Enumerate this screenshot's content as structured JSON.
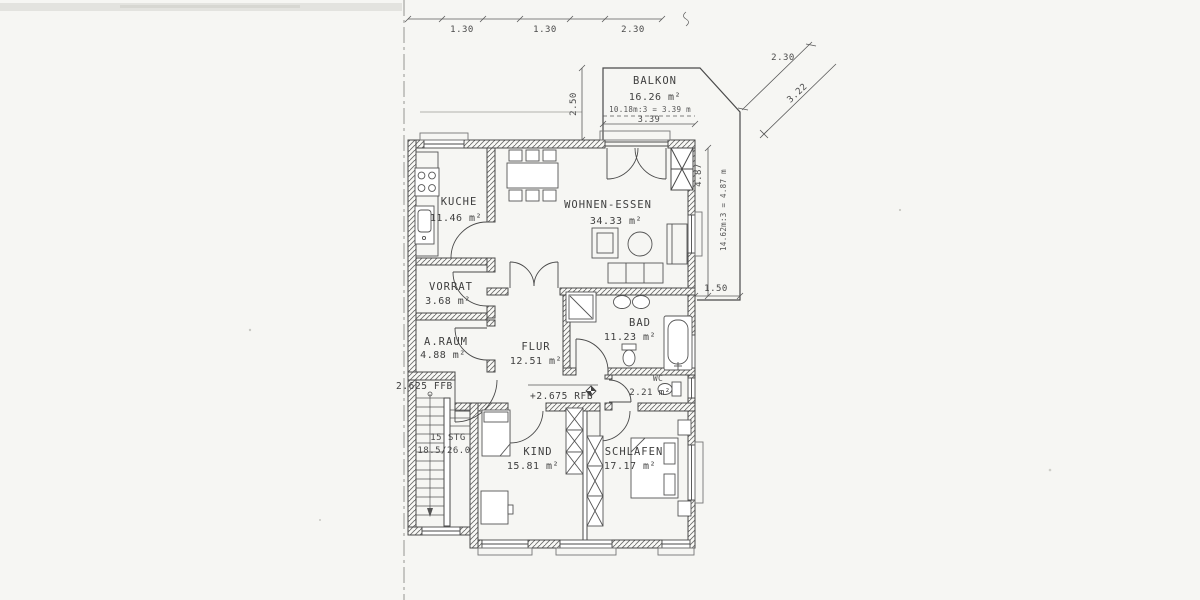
{
  "plan": {
    "rooms": {
      "balkon": {
        "name": "BALKON",
        "area": "16.26 m²"
      },
      "kueche": {
        "name": "KUCHE",
        "area": "11.46 m²"
      },
      "wohnen": {
        "name": "WOHNEN-ESSEN",
        "area": "34.33 m²"
      },
      "vorrat": {
        "name": "VORRAT",
        "area": "3.68 m²"
      },
      "araum": {
        "name": "A.RAUM",
        "area": "4.88 m²"
      },
      "flur": {
        "name": "FLUR",
        "area": "12.51 m²"
      },
      "bad": {
        "name": "BAD",
        "area": "11.23 m²"
      },
      "wc": {
        "name": "WC",
        "area": "2.21 m²"
      },
      "kind": {
        "name": "KIND",
        "area": "15.81 m²"
      },
      "schlafen": {
        "name": "SCHLAFEN",
        "area": "17.17 m²"
      }
    },
    "stairs": {
      "steps": "15 STG",
      "ratio": "18.5/26.0"
    },
    "levels": {
      "ffb": "2.625 FFB",
      "rfb": "+2.675 RFB"
    },
    "dimensions": {
      "top1": "1.30",
      "top2": "1.30",
      "top3": "2.30",
      "balkon_width": "3.39",
      "balkon_note": "10.18m:3 = 3.39 m",
      "balkon_left": "2.50",
      "right_height": "4.87",
      "right_note": "14.62m:3 = 4.87 m",
      "strip_width": "1.50",
      "diag_a": "2.30",
      "diag_b": "3.22"
    },
    "colors": {
      "ink": "#4a4a4a",
      "paper": "#f6f6f3",
      "hatch": "#6e6e6e"
    }
  }
}
